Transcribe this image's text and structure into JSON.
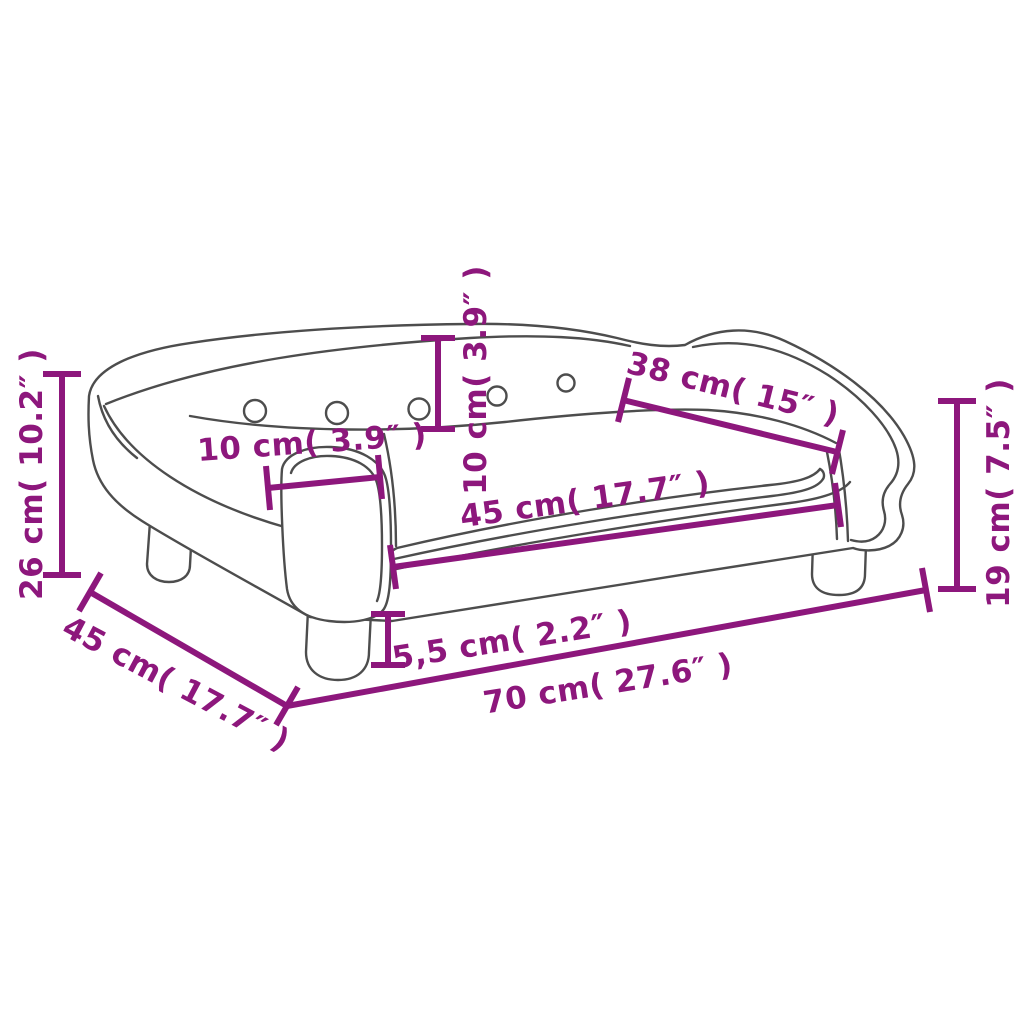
{
  "diagram": {
    "subject": "kids-sofa-line-drawing-with-dimensions",
    "colors": {
      "dimension_accent": "#8d177c",
      "outline": "#4d4d4d",
      "background": "#ffffff"
    },
    "dimensions": [
      {
        "id": "overall-height",
        "label": "26 cm( 10.2″ )",
        "placement": "vertical-left-side"
      },
      {
        "id": "overall-depth",
        "label": "45 cm( 17.7″ )",
        "placement": "diagonal-bottom-left"
      },
      {
        "id": "overall-width",
        "label": "70 cm( 27.6″ )",
        "placement": "bottom-edge"
      },
      {
        "id": "arm-height",
        "label": "19 cm( 7.5″ )",
        "placement": "vertical-right-side"
      },
      {
        "id": "backrest-length",
        "label": "38 cm( 15″ )",
        "placement": "diagonal-right-arm"
      },
      {
        "id": "armrest-width",
        "label": "10 cm( 3.9″ )",
        "placement": "horizontal-left-arm"
      },
      {
        "id": "backrest-height",
        "label": "10 cm( 3.9″ )",
        "placement": "vertical-backrest"
      },
      {
        "id": "seat-length",
        "label": "45 cm( 17.7″ )",
        "placement": "along-seat-front"
      },
      {
        "id": "leg-height",
        "label": "5,5 cm( 2.2″ )",
        "placement": "front-left-leg"
      }
    ]
  }
}
